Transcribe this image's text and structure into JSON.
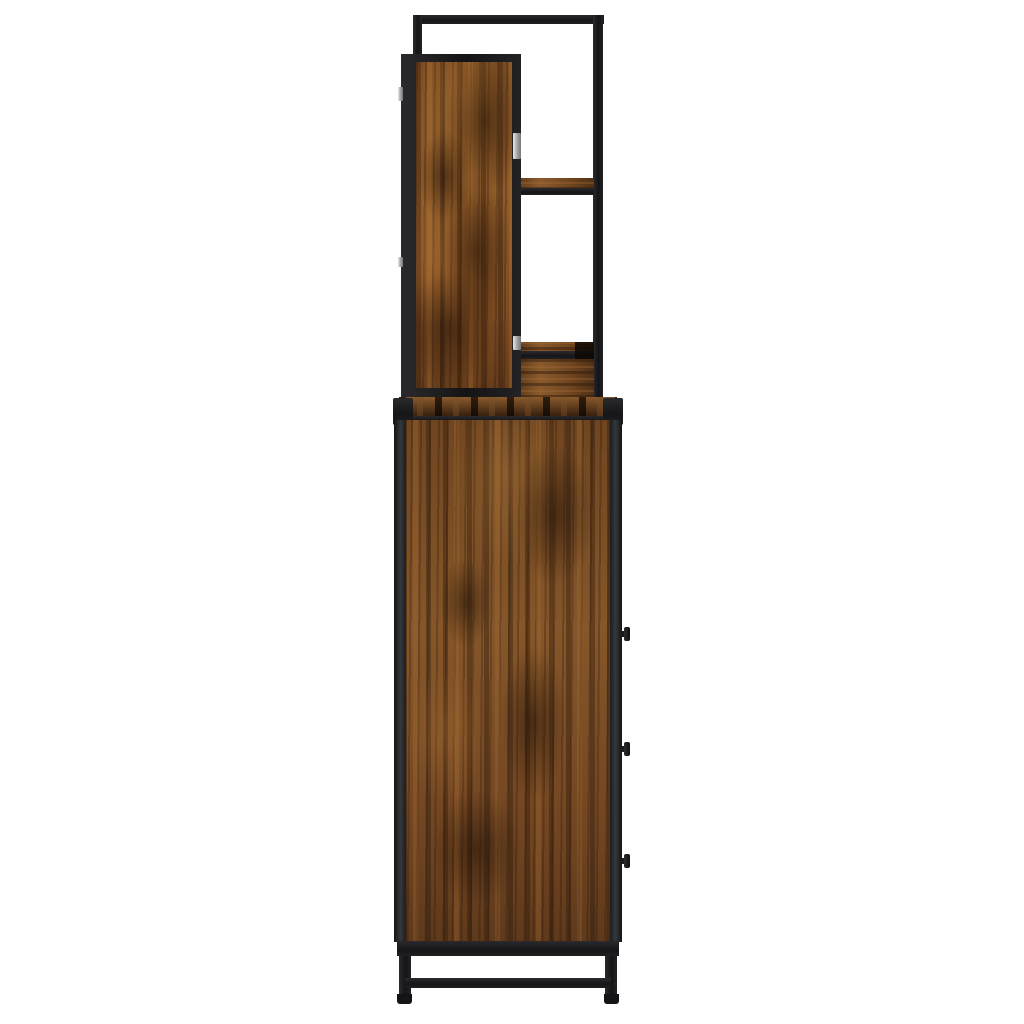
{
  "scene": {
    "description": "Side view product photo of an industrial-style bathroom storage cabinet with a mirror shelf unit on top: smoked oak wood panels in a black metal frame, three black drawer knobs on the right edge, black metal legs with a stretcher bar, on a plain white background",
    "background_color": "#ffffff"
  },
  "palette": {
    "metal_black": "#1c1c1e",
    "metal_rail_gray": "#35383b",
    "wood_base": "#7c4f26",
    "wood_dark_knot": "#2e1b0c",
    "wood_highlight": "#a3703a",
    "wood_burnt_band": "#3a2310",
    "hinge_gray": "#9a9a9a"
  },
  "parts": {
    "top_unit": {
      "name": "mirror shelf unit",
      "frame": "open black metal frame",
      "panel": "smoked oak side panel with black border",
      "upper_shelf": "wood shelf with black trim",
      "lower_compartment": "wood compartment with black trim",
      "hinge_count": 4
    },
    "cabinet": {
      "name": "storage cabinet",
      "top": "burnt smoked oak top with black edge trim and corner caps",
      "body": "smoked oak side panel with black vertical rails",
      "knob_count": 3,
      "base": "black metal legs with stretcher bar and feet"
    }
  }
}
